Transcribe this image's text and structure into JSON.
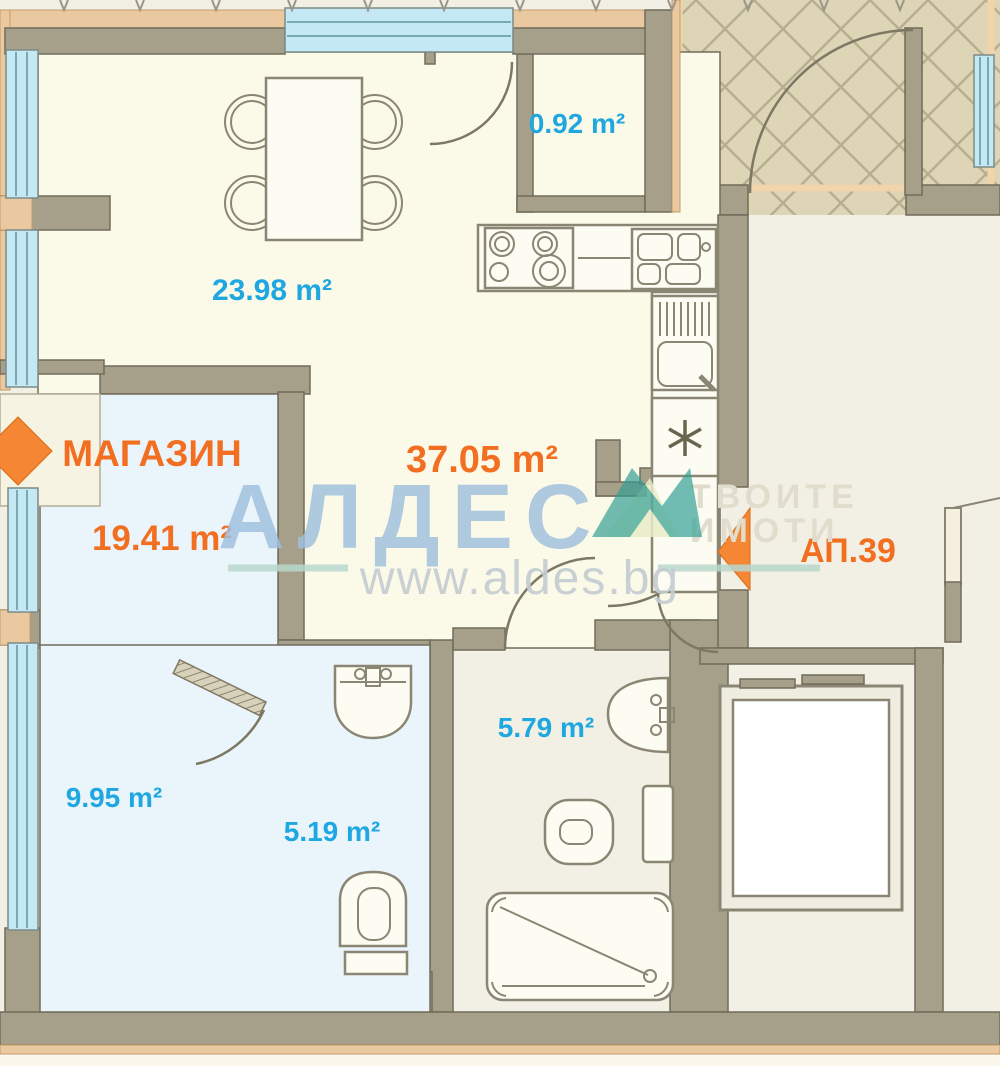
{
  "plan": {
    "labels": {
      "living_area": "23.98 m²",
      "closet_area": "0.92 m²",
      "total_area": "37.05 m²",
      "shop_name": "МАГАЗИН",
      "shop_area": "19.41 m²",
      "apartment": "АП.39",
      "bathroom_area": "5.79 m²",
      "shop_backroom_area": "9.95 m²",
      "shop_wc_area": "5.19 m²"
    },
    "watermark": {
      "brand": "АЛДЕС",
      "url": "www.aldes.bg",
      "tagline_line1": "ТВОИТЕ",
      "tagline_line2": "ИМОТИ"
    },
    "colors": {
      "label_blue": "#1ea7e0",
      "label_orange": "#f26f21",
      "wall": "#a6a08a",
      "beige_trim": "#eac9a0",
      "window_blue": "#c5e9f4",
      "room_cream": "#fbfae8",
      "room_blue": "#eaf4fb",
      "hatch_background": "#ddd5b6",
      "watermark_blue": "#9fc0de",
      "watermark_teal": "#2f9d93"
    }
  }
}
